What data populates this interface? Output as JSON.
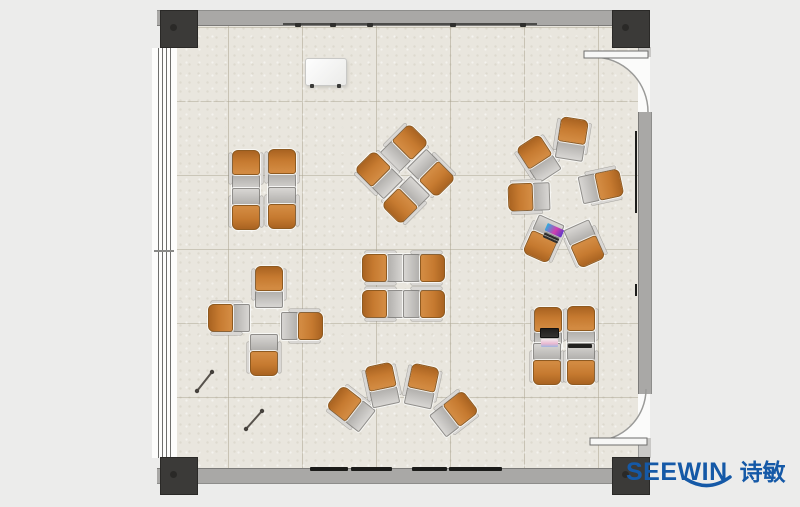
{
  "brand": {
    "logo_text": "SEEWIN",
    "logo_cjk": "诗敏",
    "color": "#1559A7"
  },
  "palette": {
    "background": "#ECECEB",
    "floor": "#E9E6DE",
    "wall": "#A9A8A6",
    "column": "#3B3A38",
    "chair": "#C97F33",
    "chair_dark": "#A96321",
    "desk": "#C2C0BD",
    "brand": "#1559A7",
    "door_arc": "#9A9A98"
  },
  "plan": {
    "clusters": [
      {
        "id": "quad-northwest",
        "units": [
          {
            "x": 246,
            "y": 170,
            "r": 180
          },
          {
            "x": 282,
            "y": 169,
            "r": 180
          },
          {
            "x": 246,
            "y": 210,
            "r": 0
          },
          {
            "x": 282,
            "y": 209,
            "r": 0
          }
        ]
      },
      {
        "id": "pinwheel-north",
        "units": [
          {
            "x": 405,
            "y": 147,
            "r": 225
          },
          {
            "x": 432,
            "y": 174,
            "r": 315
          },
          {
            "x": 405,
            "y": 201,
            "r": 45
          },
          {
            "x": 378,
            "y": 174,
            "r": 135
          }
        ]
      },
      {
        "id": "circle-northeast",
        "units": [
          {
            "x": 538,
            "y": 158,
            "r": 147
          },
          {
            "x": 572,
            "y": 138,
            "r": 189
          },
          {
            "x": 602,
            "y": 186,
            "r": 258
          },
          {
            "x": 585,
            "y": 245,
            "r": 336
          },
          {
            "x": 543,
            "y": 240,
            "r": 24
          },
          {
            "x": 528,
            "y": 197,
            "r": 88
          }
        ]
      },
      {
        "id": "cross-west",
        "units": [
          {
            "x": 269,
            "y": 286,
            "r": 180
          },
          {
            "x": 228,
            "y": 318,
            "r": 90
          },
          {
            "x": 303,
            "y": 326,
            "r": 270
          },
          {
            "x": 264,
            "y": 356,
            "r": 0
          }
        ]
      },
      {
        "id": "quad-center",
        "units": [
          {
            "x": 382,
            "y": 268,
            "r": 90
          },
          {
            "x": 425,
            "y": 268,
            "r": 270
          },
          {
            "x": 382,
            "y": 304,
            "r": 90
          },
          {
            "x": 425,
            "y": 304,
            "r": 270
          }
        ]
      },
      {
        "id": "fan-south",
        "units": [
          {
            "x": 350,
            "y": 408,
            "r": 128
          },
          {
            "x": 382,
            "y": 384,
            "r": 168
          },
          {
            "x": 422,
            "y": 385,
            "r": 192
          },
          {
            "x": 455,
            "y": 413,
            "r": 232
          }
        ]
      },
      {
        "id": "quad-southeast",
        "units": [
          {
            "x": 548,
            "y": 327,
            "r": 180
          },
          {
            "x": 581,
            "y": 326,
            "r": 180
          },
          {
            "x": 547,
            "y": 365,
            "r": 0
          },
          {
            "x": 581,
            "y": 365,
            "r": 0
          }
        ]
      }
    ],
    "laptops": [
      {
        "x": 553,
        "y": 233,
        "r": 24,
        "w": 18,
        "h": 15,
        "variant": "laptop-color"
      },
      {
        "x": 549,
        "y": 337,
        "r": 0,
        "w": 19,
        "h": 19,
        "variant": "laptop-dark"
      }
    ],
    "tablet": {
      "x": 580,
      "y": 346,
      "w": 24,
      "h": 4
    },
    "whiteboard": {
      "x": 305,
      "y": 58,
      "w": 40,
      "h": 26
    },
    "pointers": [
      {
        "x1": 197,
        "y1": 391,
        "x2": 212,
        "y2": 372
      },
      {
        "x1": 246,
        "y1": 429,
        "x2": 262,
        "y2": 411
      }
    ],
    "wall_boards": [
      {
        "x": 310,
        "w": 38
      },
      {
        "x": 351,
        "w": 41
      },
      {
        "x": 412,
        "w": 35
      },
      {
        "x": 449,
        "w": 53
      }
    ],
    "rail_marks": [
      295,
      330,
      367,
      450,
      520
    ]
  }
}
